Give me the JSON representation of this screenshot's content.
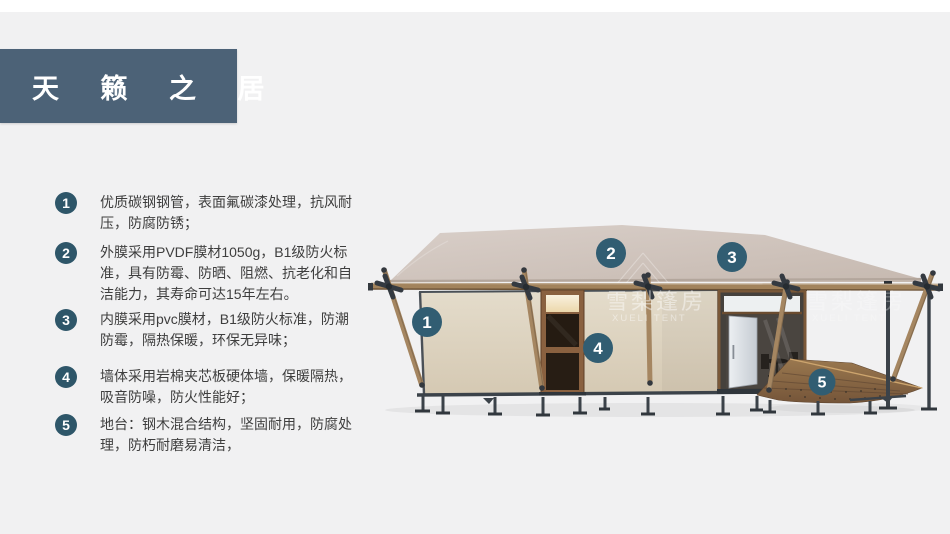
{
  "slide": {
    "title": "天 籁 之 居",
    "features": [
      {
        "num": "1",
        "text": "优质碳钢钢管，表面氟碳漆处理，抗风耐压，防腐防锈；"
      },
      {
        "num": "2",
        "text": "外膜采用PVDF膜材1050g，B1级防火标准，具有防霉、防晒、阻燃、抗老化和自洁能力，其寿命可达15年左右。"
      },
      {
        "num": "3",
        "text": "内膜采用pvc膜材，B1级防火标准，防潮防霉，隔热保暖，环保无异味；"
      },
      {
        "num": "4",
        "text": "墙体采用岩棉夹芯板硬体墙，保暖隔热，吸音防噪，防火性能好；"
      },
      {
        "num": "5",
        "text": "地台：钢木混合结构，坚固耐用，防腐处理，防朽耐磨易清洁，"
      }
    ],
    "callouts": [
      {
        "num": "1"
      },
      {
        "num": "2"
      },
      {
        "num": "3"
      },
      {
        "num": "4"
      },
      {
        "num": "5"
      }
    ],
    "watermark": {
      "cn": "雪梨篷房",
      "en": "XUELI TENT"
    },
    "colors": {
      "background": "#f1f1f2",
      "title_bg": "#4c6277",
      "badge": "#2e5669",
      "callout_badge": "#315d72",
      "roof": "#cfc3ba",
      "wall": "#ded5c4",
      "wood": "#a2835c",
      "steel": "#3b4249",
      "deck": "#8a6a46",
      "text": "#3e3e3e"
    }
  }
}
